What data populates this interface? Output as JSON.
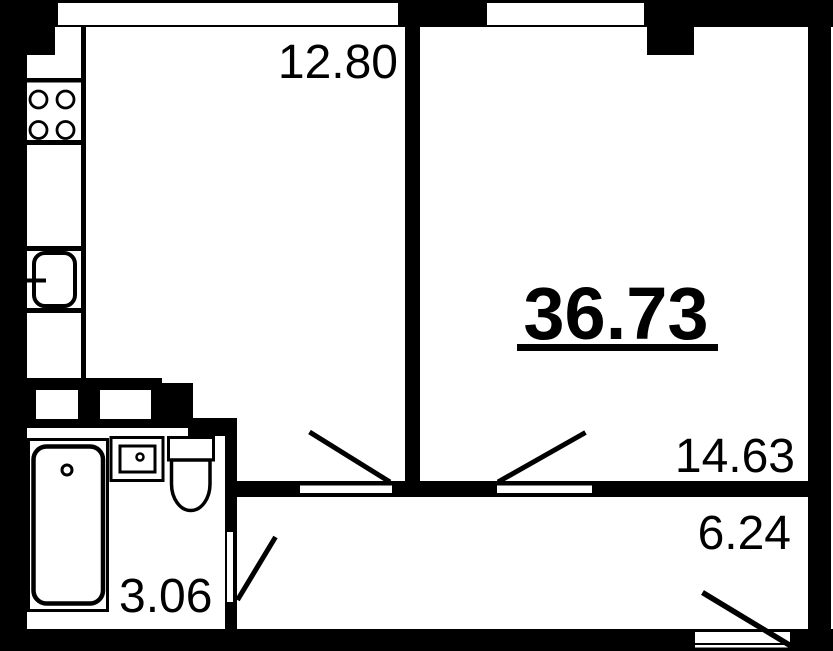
{
  "floorplan": {
    "unit_total_area": "36.73",
    "rooms": [
      {
        "id": "living-kitchen",
        "area": "12.80"
      },
      {
        "id": "bedroom",
        "area": "14.63"
      },
      {
        "id": "hallway",
        "area": "6.24"
      },
      {
        "id": "bathroom",
        "area": "3.06"
      }
    ],
    "fixtures": [
      "stove-icon",
      "kitchen-sink-icon",
      "bathtub-icon",
      "washbasin-icon",
      "toilet-icon",
      "vent-shaft",
      "door-swing",
      "window"
    ],
    "colors": {
      "wall": "#000000",
      "background": "#ffffff",
      "text": "#000000"
    }
  }
}
